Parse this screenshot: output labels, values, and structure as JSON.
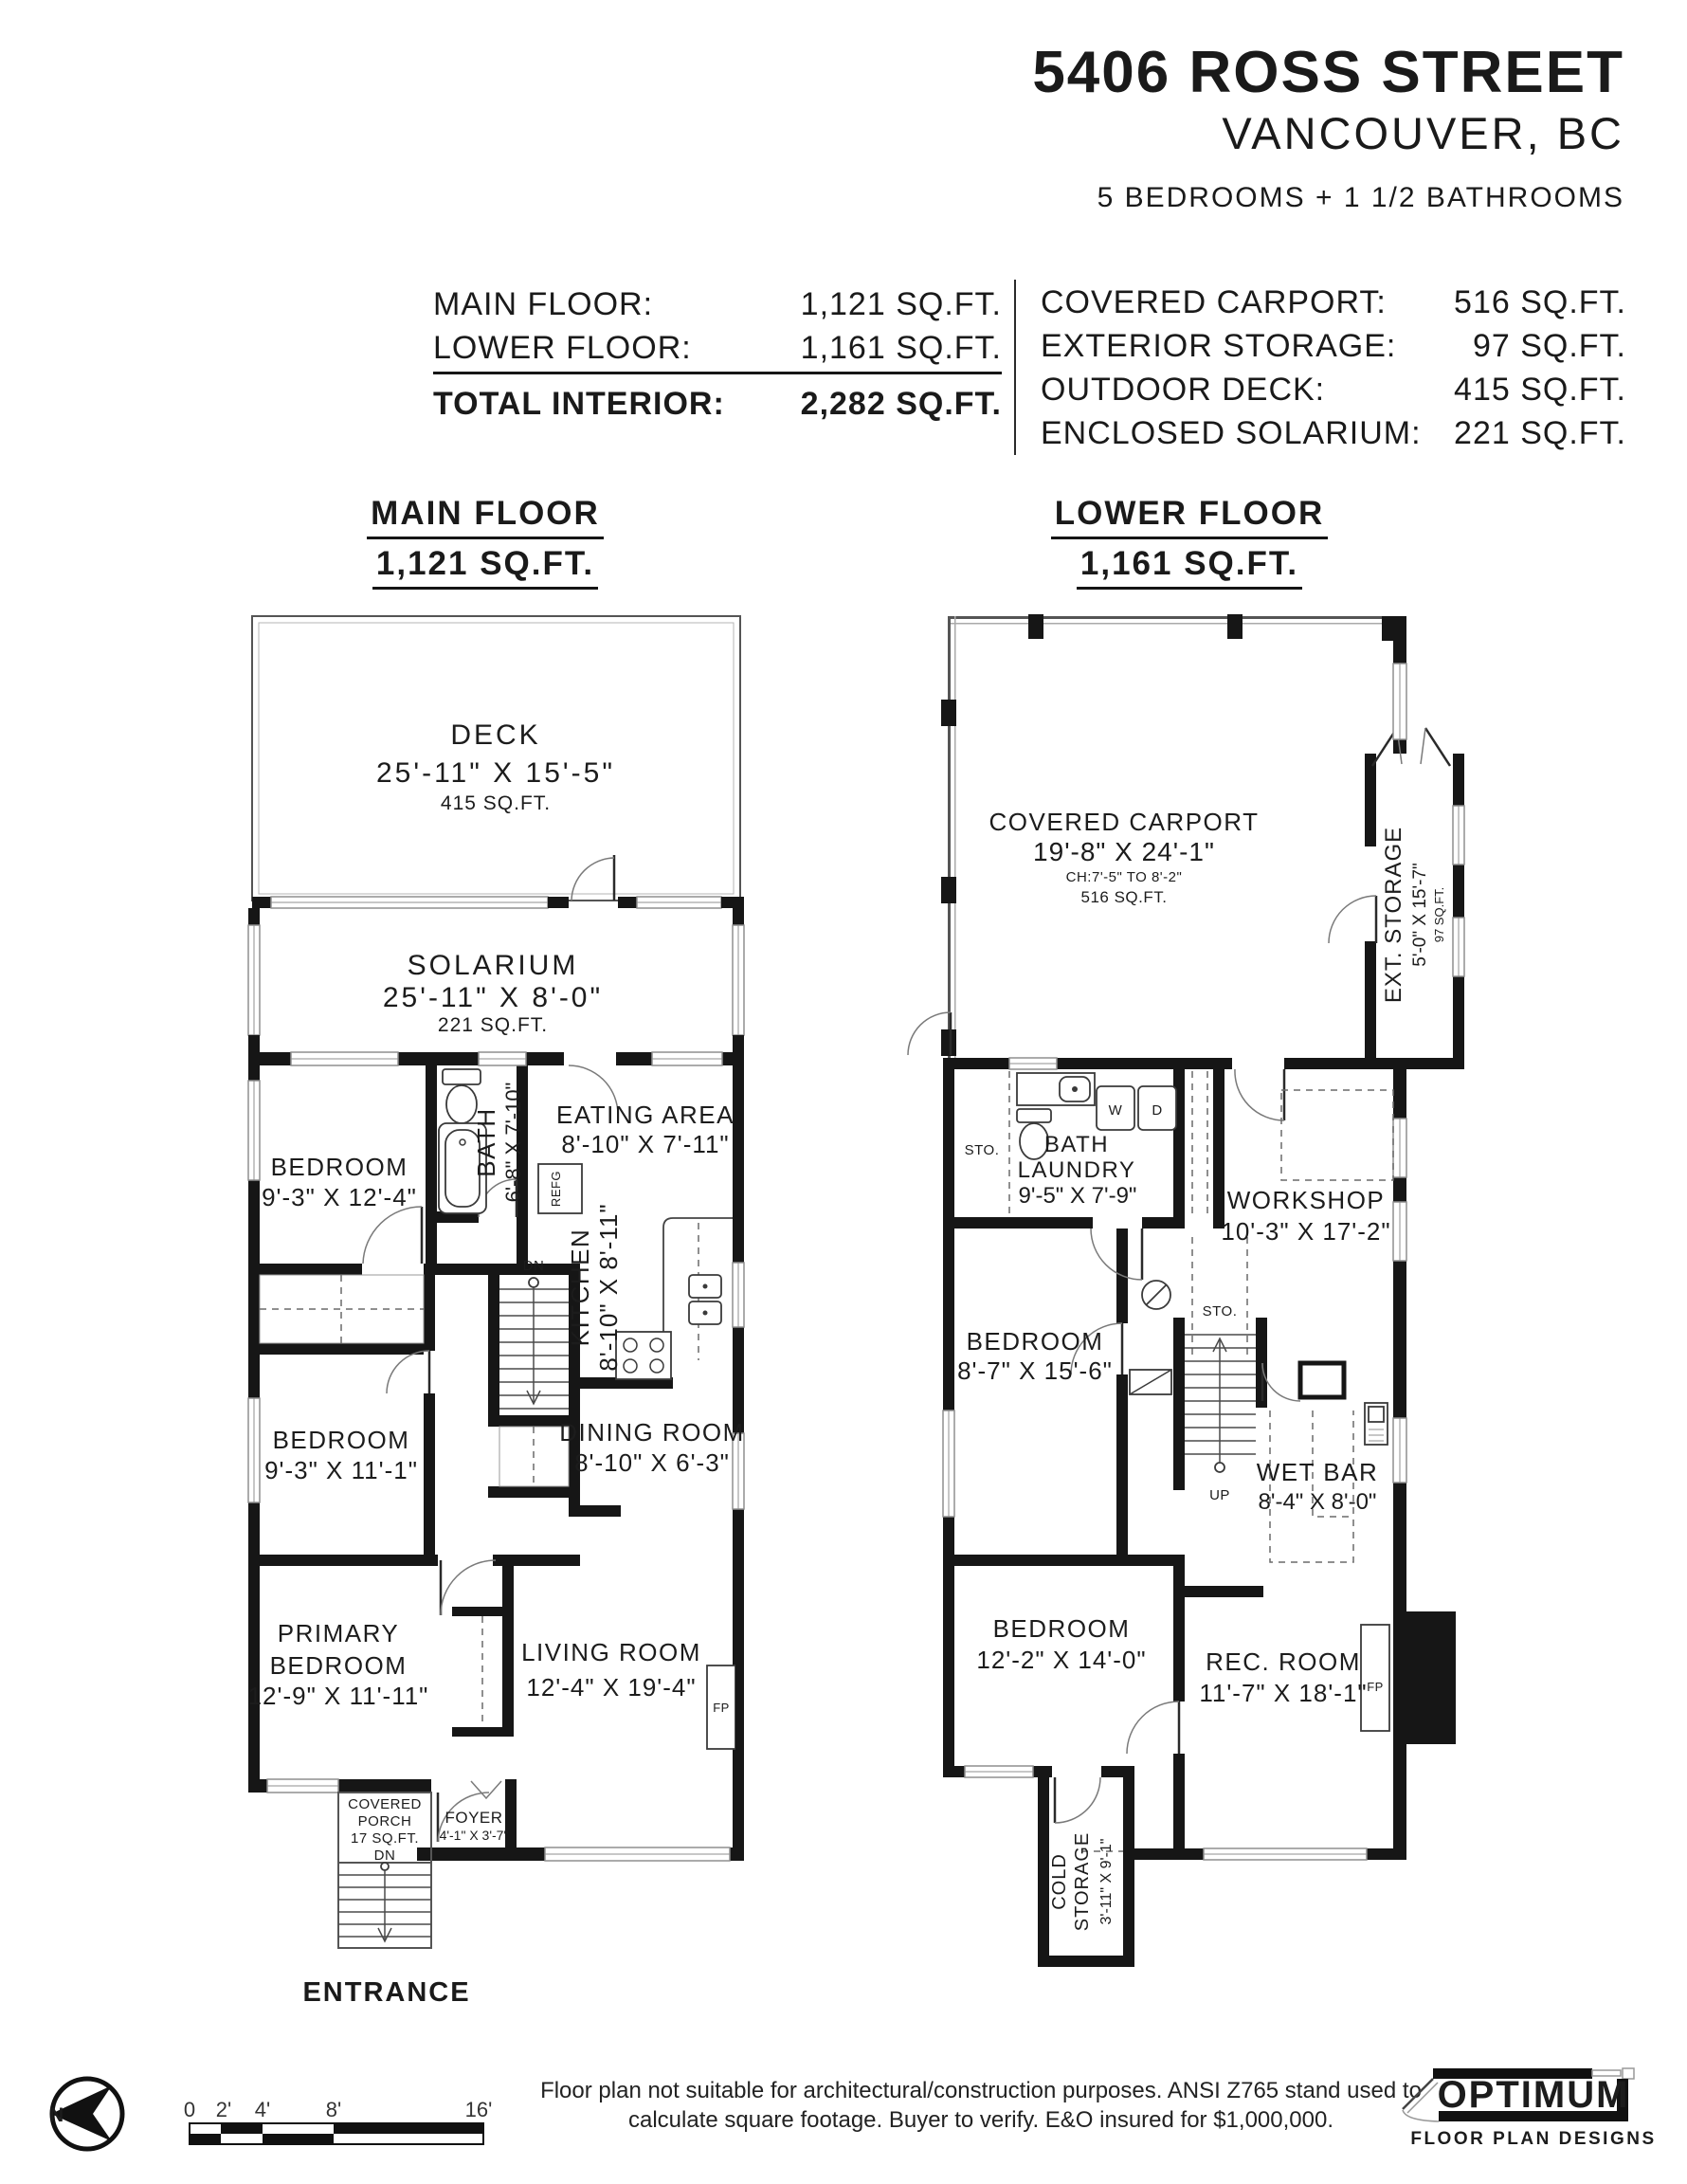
{
  "header": {
    "address": "5406 ROSS STREET",
    "city": "VANCOUVER, BC",
    "beds_baths": "5 BEDROOMS + 1 1/2 BATHROOMS"
  },
  "areas": {
    "left": [
      {
        "label": "MAIN FLOOR:",
        "value": "1,121 SQ.FT."
      },
      {
        "label": "LOWER FLOOR:",
        "value": "1,161 SQ.FT."
      },
      {
        "label": "TOTAL INTERIOR:",
        "value": "2,282 SQ.FT."
      }
    ],
    "right": [
      {
        "label": "COVERED CARPORT:",
        "value": "516 SQ.FT."
      },
      {
        "label": "EXTERIOR STORAGE:",
        "value": "97 SQ.FT."
      },
      {
        "label": "OUTDOOR DECK:",
        "value": "415 SQ.FT."
      },
      {
        "label": "ENCLOSED SOLARIUM:",
        "value": "221 SQ.FT."
      }
    ]
  },
  "main_floor": {
    "title": "MAIN FLOOR",
    "subtitle": "1,121 SQ.FT.",
    "deck": {
      "name": "DECK",
      "dims": "25'-11\" X 15'-5\"",
      "sqft": "415 SQ.FT."
    },
    "solarium": {
      "name": "SOLARIUM",
      "dims": "25'-11\" X 8'-0\"",
      "sqft": "221 SQ.FT."
    },
    "bedroom1": {
      "name": "BEDROOM",
      "dims": "9'-3\" X 12'-4\""
    },
    "bath": {
      "name": "BATH",
      "dims": "6'-8\" X 7'-10\""
    },
    "eating": {
      "name": "EATING AREA",
      "dims": "8'-10\" X 7'-11\""
    },
    "kitchen": {
      "name": "KITCHEN",
      "dims": "8'-10\" X 8'-11\""
    },
    "refg": "REFG",
    "dn": "DN",
    "dining": {
      "name": "DINING ROOM",
      "dims": "8'-10\" X 6'-3\""
    },
    "bedroom2": {
      "name": "BEDROOM",
      "dims": "9'-3\" X 11'-1\""
    },
    "primary": {
      "line1": "PRIMARY",
      "line2": "BEDROOM",
      "dims": "12'-9\" X 11'-11\""
    },
    "living": {
      "name": "LIVING ROOM",
      "dims": "12'-4\" X 19'-4\""
    },
    "fp": "FP",
    "porch": {
      "line1": "COVERED",
      "line2": "PORCH",
      "line3": "17 SQ.FT.",
      "line4": "DN"
    },
    "foyer": {
      "name": "FOYER",
      "dims": "4'-1\" X 3'-7\""
    },
    "entrance": "ENTRANCE"
  },
  "lower_floor": {
    "title": "LOWER FLOOR",
    "subtitle": "1,161 SQ.FT.",
    "carport": {
      "name": "COVERED CARPORT",
      "dims": "19'-8\" X 24'-1\"",
      "ch": "CH:7'-5\" TO 8'-2\"",
      "sqft": "516 SQ.FT."
    },
    "ext_storage": {
      "name": "EXT. STORAGE",
      "dims": "5'-0\" X 15'-7\"",
      "sqft": "97 SQ.FT."
    },
    "sto1": "STO.",
    "sto2": "STO.",
    "bath_laundry": {
      "line1": "BATH",
      "line2": "LAUNDRY",
      "dims": "9'-5\" X 7'-9\""
    },
    "washer": "W",
    "dryer": "D",
    "workshop": {
      "name": "WORKSHOP",
      "dims": "10'-3\" X 17'-2\""
    },
    "bedroom1": {
      "name": "BEDROOM",
      "dims": "8'-7\" X 15'-6\""
    },
    "up": "UP",
    "wetbar": {
      "name": "WET BAR",
      "dims": "8'-4\" X 8'-0\""
    },
    "bedroom2": {
      "name": "BEDROOM",
      "dims": "12'-2\" X 14'-0\""
    },
    "rec": {
      "name": "REC. ROOM",
      "dims": "11'-7\" X 18'-1\""
    },
    "fp": "FP",
    "cold": {
      "line1": "COLD",
      "line2": "STORAGE",
      "dims": "3'-11\" X 9'-1\""
    }
  },
  "footer": {
    "north": "N",
    "scale": {
      "t0": "0",
      "t1": "2'",
      "t2": "4'",
      "t3": "8'",
      "t4": "16'"
    },
    "disclaimer1": "Floor plan not suitable for architectural/construction purposes. ANSI Z765 stand used to",
    "disclaimer2": "calculate square footage. Buyer to verify.  E&O insured for $1,000,000.",
    "logo": {
      "name": "OPTIMUM",
      "tagline": "FLOOR PLAN DESIGNS"
    }
  },
  "colors": {
    "wall": "#161616",
    "window": "#8f8f8f",
    "background": "#ffffff"
  }
}
